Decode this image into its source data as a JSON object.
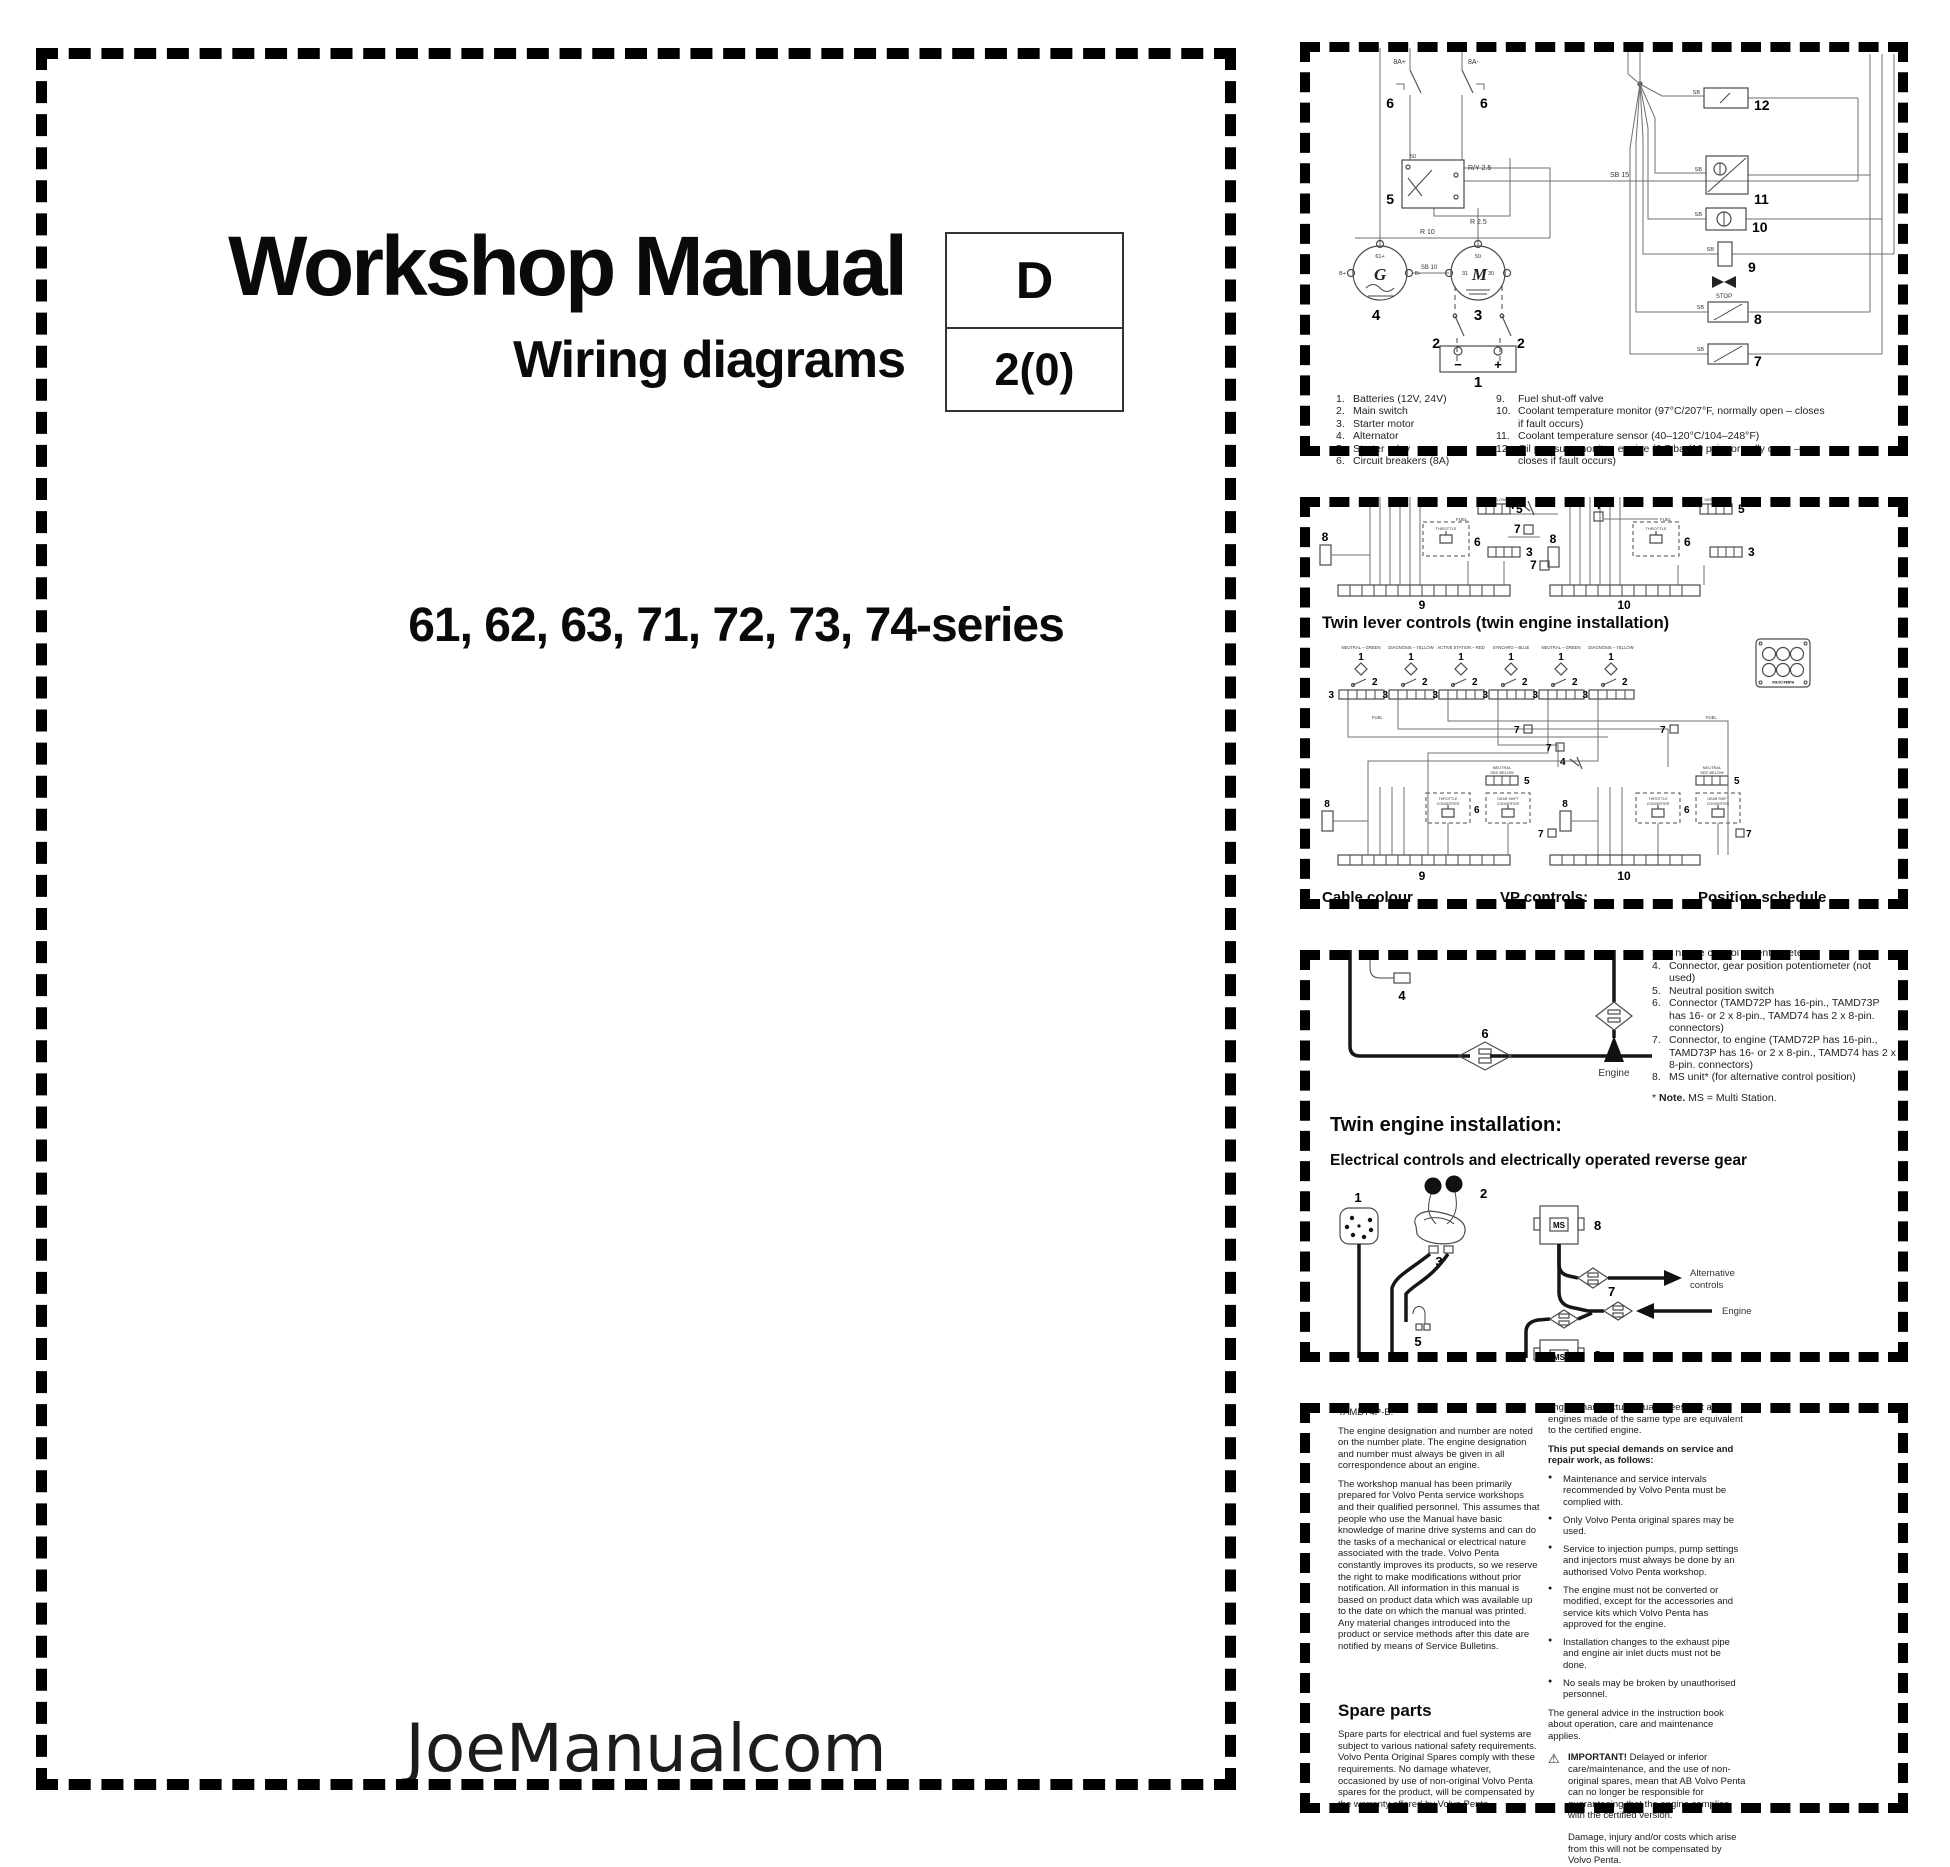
{
  "cover": {
    "title": "Workshop Manual",
    "subtitle": "Wiring diagrams",
    "code_letter": "D",
    "code_number": "2(0)",
    "series": "61, 62, 63, 71, 72, 73, 74-series",
    "watermark": "JoeManualcom"
  },
  "panel1": {
    "labels": {
      "n1": "1",
      "n2": "2",
      "n3": "3",
      "n4": "4",
      "n5": "5",
      "n6": "6",
      "n7": "7",
      "n8": "8",
      "n9": "9",
      "n10": "10",
      "n11": "11",
      "n12": "12",
      "breaker_plus": "8A+",
      "breaker_minus": "8A-",
      "stop": "STOP",
      "g": "G",
      "m": "M",
      "t50": "50",
      "t31": "31",
      "t30": "30",
      "t61": "61+",
      "bplus": "B+",
      "bminus": "B-",
      "w_ry25": "R/Y 2.5",
      "w_r25": "R 2.5",
      "w_r10": "R 10",
      "w_sb10": "SB 10",
      "w_sb15": "SB 15",
      "w_sb": "SB",
      "minus": "−",
      "plus": "+"
    },
    "legend_left": [
      {
        "n": "1.",
        "t": "Batteries (12V, 24V)"
      },
      {
        "n": "2.",
        "t": "Main switch"
      },
      {
        "n": "3.",
        "t": "Starter motor"
      },
      {
        "n": "4.",
        "t": "Alternator"
      },
      {
        "n": "5.",
        "t": "Starter relay"
      },
      {
        "n": "6.",
        "t": "Circuit breakers (8A)"
      }
    ],
    "legend_right": [
      {
        "n": "9.",
        "t": "Fuel shut-off valve"
      },
      {
        "n": "10.",
        "t": "Coolant temperature monitor (97°C/207°F, normally open – closes if fault occurs)"
      },
      {
        "n": "11.",
        "t": "Coolant temperature sensor (40–120°C/104–248°F)"
      },
      {
        "n": "12.",
        "t": "Oil pressure monitor, engine (0.7 bar/10 psi, normally open – closes if fault occurs)"
      }
    ]
  },
  "panel2": {
    "heading": "Twin lever controls (twin engine installation)",
    "unit_captions": [
      "NEUTRAL – GREEN",
      "DIAGNOSIS – YELLOW",
      "ACTIVE STATION – RED",
      "SYNCHRO – BLUE",
      "NEUTRAL – GREEN",
      "DIAGNOSIS – YELLOW"
    ],
    "labels": {
      "n1": "1",
      "n2": "2",
      "n3": "3",
      "n4": "4",
      "n5": "5",
      "n6": "6",
      "n7": "7",
      "n8": "8",
      "n9": "9",
      "n10": "10",
      "throttle": "THROTTLE",
      "throttle_conv1": "THROTTLE",
      "throttle_conv2": "CONVERTER",
      "gear_conv1": "GEAR SHIFT",
      "gear_conv2": "CONVERTER",
      "neutral1": "NEUTRAL",
      "neutral2": "SEE BELOW",
      "fuel": "FUEL",
      "brand": "VOLVO PENTA"
    },
    "footer": [
      "Cable colour",
      "VP controls:",
      "Position schedule"
    ]
  },
  "panel3": {
    "legend_top_hidden": {
      "n": "3.",
      "t": "Throttle control potentiometer"
    },
    "legend": [
      {
        "n": "4.",
        "t": "Connector, gear position potentiometer (not used)"
      },
      {
        "n": "5.",
        "t": "Neutral position switch"
      },
      {
        "n": "6.",
        "t": "Connector (TAMD72P has 16-pin., TAMD73P has 16- or 2 x 8-pin., TAMD74 has 2 x 8-pin. connectors)"
      },
      {
        "n": "7.",
        "t": "Connector, to engine (TAMD72P has 16-pin., TAMD73P has 16- or 2 x 8-pin., TAMD74 has 2 x 8-pin. connectors)"
      },
      {
        "n": "8.",
        "t": "MS unit* (for alternative control position)"
      }
    ],
    "note_star": "* ",
    "note_bold": "Note.",
    "note_rest": " MS = Multi Station.",
    "heading": "Twin engine installation:",
    "subheading": "Electrical controls and electrically operated reverse gear",
    "labels": {
      "n1": "1",
      "n2": "2",
      "n3": "3",
      "n4": "4",
      "n5": "5",
      "n6": "6",
      "n7": "7",
      "n8": "8",
      "ms": "MS",
      "engine": "Engine",
      "alt1": "Alternative",
      "alt2": "controls"
    }
  },
  "panel4": {
    "left": {
      "model": "TAMD74P-B.",
      "para1": "The engine designation and number are noted on the number plate. The engine designation and number must always be given in all correspondence about an engine.",
      "para2": "The workshop manual has been primarily prepared for Volvo Penta service workshops and their qualified personnel. This assumes that people who use the Manual have basic knowledge of marine drive systems and can do the tasks of a mechanical or electrical nature associated with the trade. Volvo Penta constantly improves its products, so we reserve the right to make modifications without prior notification. All information in this manual is based on product data which was available up to the date on which the manual was printed. Any material changes introduced into the product or service methods after this date are notified by means of Service Bulletins.",
      "spare_heading": "Spare parts",
      "spare_para": "Spare parts for electrical and fuel systems are subject to various national safety requirements. Volvo Penta Original Spares comply with these requirements. No damage whatever, occasioned by use of non-original Volvo Penta spares for the product, will be compensated by the warranty offered by Volvo Penta."
    },
    "right": {
      "intro": "engine manufacturer guarantees that all engines made of the same type are equivalent to the certified engine.",
      "demands_heading": "This put special demands on service and repair work, as follows:",
      "bullets": [
        {
          "t": "Maintenance and service intervals recommended by Volvo Penta must be complied with."
        },
        {
          "t": "Only Volvo Penta original spares may be used."
        },
        {
          "t": "Service to injection pumps, pump settings and injectors must always be done by an authorised Volvo Penta workshop."
        },
        {
          "t": "The engine must not be converted or modified, except for the accessories and service kits which Volvo Penta has approved for the engine."
        },
        {
          "t": "Installation changes to the exhaust pipe and engine air inlet ducts must not be done."
        },
        {
          "t": "No seals may be broken by unauthorised personnel."
        }
      ],
      "general": "The general advice in the instruction book about operation, care and maintenance applies.",
      "warning_icon": "⚠",
      "important_label": "IMPORTANT!",
      "important_text": " Delayed or inferior care/maintenance, and the use of non-original spares, mean that AB Volvo Penta can no longer be responsible for guaranteeing that the engine complies with the certified version.",
      "damage": "Damage, injury and/or costs which arise from this will not be compensated by Volvo Penta."
    }
  }
}
